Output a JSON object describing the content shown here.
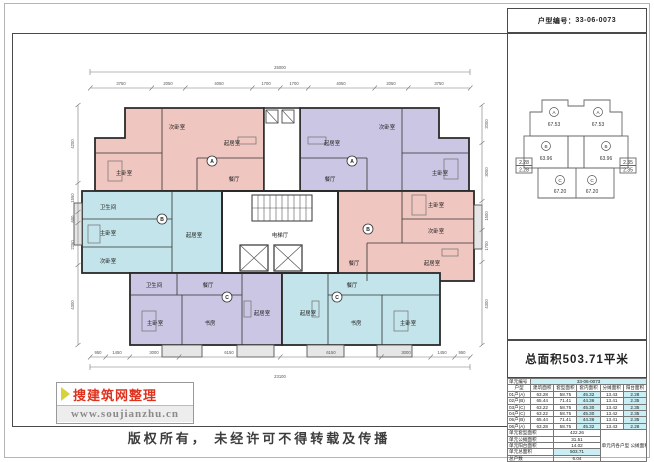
{
  "header": {
    "code_label": "户型编号：",
    "code": "33-06-0073"
  },
  "plan": {
    "room_labels": {
      "master": "主卧室",
      "second": "次卧室",
      "living": "起居室",
      "dining": "餐厅",
      "kitchen": "厨房",
      "bath": "卫生间",
      "study": "书房",
      "balcony": "阳台",
      "elevator_hall": "电梯厅",
      "stairs": "楼梯"
    },
    "unit_marks": [
      "A",
      "A",
      "B",
      "B",
      "C",
      "C"
    ],
    "dims": {
      "top_total": "25000",
      "top_segments": [
        "3750",
        "2050",
        "4050",
        "1700",
        "1700",
        "4050",
        "2050",
        "3750"
      ],
      "bottom_total": "23100",
      "bottom_segments": [
        "950",
        "1450",
        "3000",
        "6150",
        "6150",
        "3000",
        "1450",
        "950"
      ],
      "left_segments": [
        "4200",
        "1550",
        "600",
        "2250",
        "4300"
      ],
      "right_segments": [
        "2000",
        "3000",
        "1500",
        "1700",
        "4300"
      ]
    }
  },
  "keyplan": {
    "units": [
      {
        "label": "A",
        "area": "67.53"
      },
      {
        "label": "A",
        "area": "67.53"
      },
      {
        "label": "B",
        "area": "63.96"
      },
      {
        "label": "B",
        "area": "63.96"
      },
      {
        "label": "C",
        "area": "67.20"
      },
      {
        "label": "C",
        "area": "67.20"
      }
    ],
    "left_tag_top": "2.28",
    "left_tag_bottom": "2.28",
    "right_tag_top": "2.35",
    "right_tag_bottom": "2.35"
  },
  "summary_area": "总面积503.71平米",
  "table": {
    "unit_row_label": "单元编号",
    "unit_row_value": "33-06-0073",
    "headers": [
      "户型",
      "建筑面积",
      "套型面积",
      "套内面积",
      "分摊面积",
      "阳台面积"
    ],
    "rows": [
      [
        "01户(A)",
        "63.28",
        "58.75",
        "45.32",
        "13.43",
        "2.28"
      ],
      [
        "02户(B)",
        "65.44",
        "71.41",
        "44.36",
        "13.41",
        "2.35"
      ],
      [
        "03户(C)",
        "63.22",
        "58.75",
        "45.30",
        "13.42",
        "2.35"
      ],
      [
        "04户(C)",
        "63.22",
        "58.75",
        "45.30",
        "13.42",
        "2.35"
      ],
      [
        "05户(B)",
        "65.44",
        "71.41",
        "44.36",
        "13.41",
        "2.35"
      ],
      [
        "06户(A)",
        "63.28",
        "58.75",
        "45.32",
        "13.43",
        "2.28"
      ]
    ],
    "summary": [
      {
        "label": "单元套型面积",
        "value": "422.26",
        "highlight": false
      },
      {
        "label": "单元公摊面积",
        "value": "31.51",
        "highlight": false
      },
      {
        "label": "单元阳台面积",
        "value": "14.02",
        "highlight": false
      },
      {
        "label": "单元总面积",
        "value": "503.71",
        "highlight": true
      },
      {
        "label": "总户数",
        "value": "6.04",
        "highlight": false
      }
    ],
    "note": "单元内各户型 公摊面积合计"
  },
  "watermark": {
    "brand": "搜建筑网整理",
    "url": "www.soujianzhu.cn"
  },
  "footer": {
    "copyright": "版权所有， 未经许可不得转载及传播"
  },
  "colors": {
    "pink": "#f0c6c0",
    "lavender": "#cac6e4",
    "cyan": "#c2e4ea",
    "highlight": "#c9eef3"
  }
}
